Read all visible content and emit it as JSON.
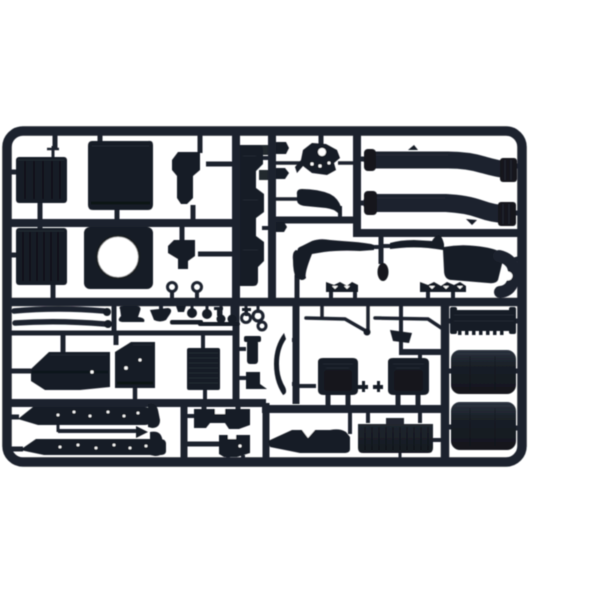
{
  "scene": {
    "description": "Product photograph of an unpainted black injection-molded plastic model kit sprue (parts tree) holding truck model components, on a plain white background",
    "caption": "Black plastic model kit sprue with truck parts",
    "colors": {
      "bg": "#ffffff",
      "plastic": "#1e242e",
      "plastic-mid": "#181d25",
      "plastic-dark": "#12161d",
      "plastic-light": "#2e3642",
      "hole": "#ffffff"
    }
  },
  "sprue": {
    "material": "black styrene plastic",
    "frame_shape": "rounded rectangle with internal runner bars",
    "parts": [
      {
        "id": "radiator-grille-upper",
        "name": "ribbed radiator grille panel"
      },
      {
        "id": "cab-roof-panel",
        "name": "cab roof panel"
      },
      {
        "id": "step-bracket-upper",
        "name": "cab step bracket"
      },
      {
        "id": "radiator-grille-lower",
        "name": "ribbed radiator core panel"
      },
      {
        "id": "fan-shroud",
        "name": "fan shroud with round opening"
      },
      {
        "id": "step-bracket-lower",
        "name": "cab step bracket"
      },
      {
        "id": "front-bumper",
        "name": "front bumper (vertical in frame)"
      },
      {
        "id": "engine-detail",
        "name": "engine ancillary with holes"
      },
      {
        "id": "sun-visor",
        "name": "sun visor / air deflector"
      },
      {
        "id": "exhaust-pipe-upper",
        "name": "curved exhaust pipe"
      },
      {
        "id": "exhaust-pipe-lower",
        "name": "curved exhaust pipe"
      },
      {
        "id": "chassis-fender-left",
        "name": "chassis fender with scalloped feet"
      },
      {
        "id": "chassis-fender-right",
        "name": "chassis fender with elbow pipe"
      },
      {
        "id": "wheel-hub",
        "name": "small hub knob"
      },
      {
        "id": "leaf-springs",
        "name": "pair of leaf springs"
      },
      {
        "id": "small-fittings",
        "name": "tow rings, ball pins and bushings"
      },
      {
        "id": "battery-box",
        "name": "stepped battery box"
      },
      {
        "id": "engine-block",
        "name": "engine block"
      },
      {
        "id": "radiator-core",
        "name": "ribbed core panel"
      },
      {
        "id": "stack-bracket",
        "name": "small stack and bracket"
      },
      {
        "id": "fender-blade",
        "name": "curved wheel-arch blade"
      },
      {
        "id": "wiper-arms",
        "name": "two windshield wiper arms"
      },
      {
        "id": "shift-lever",
        "name": "shift lever"
      },
      {
        "id": "seat-bases",
        "name": "two seat bases"
      },
      {
        "id": "intake-grille-bar",
        "name": "toothed intake grille bar"
      },
      {
        "id": "fuel-tank-1",
        "name": "rounded fuel tank"
      },
      {
        "id": "fuel-tank-2",
        "name": "rounded fuel tank"
      },
      {
        "id": "chassis-rails",
        "name": "two riveted chassis rails"
      },
      {
        "id": "drive-shaft",
        "name": "drive shaft rod"
      },
      {
        "id": "gearbox-block",
        "name": "gearbox block"
      },
      {
        "id": "transfer-case",
        "name": "transfer case block"
      },
      {
        "id": "mud-flap",
        "name": "mud flap"
      },
      {
        "id": "cab-rear-panel",
        "name": "ribbed cab rear panel"
      }
    ]
  }
}
